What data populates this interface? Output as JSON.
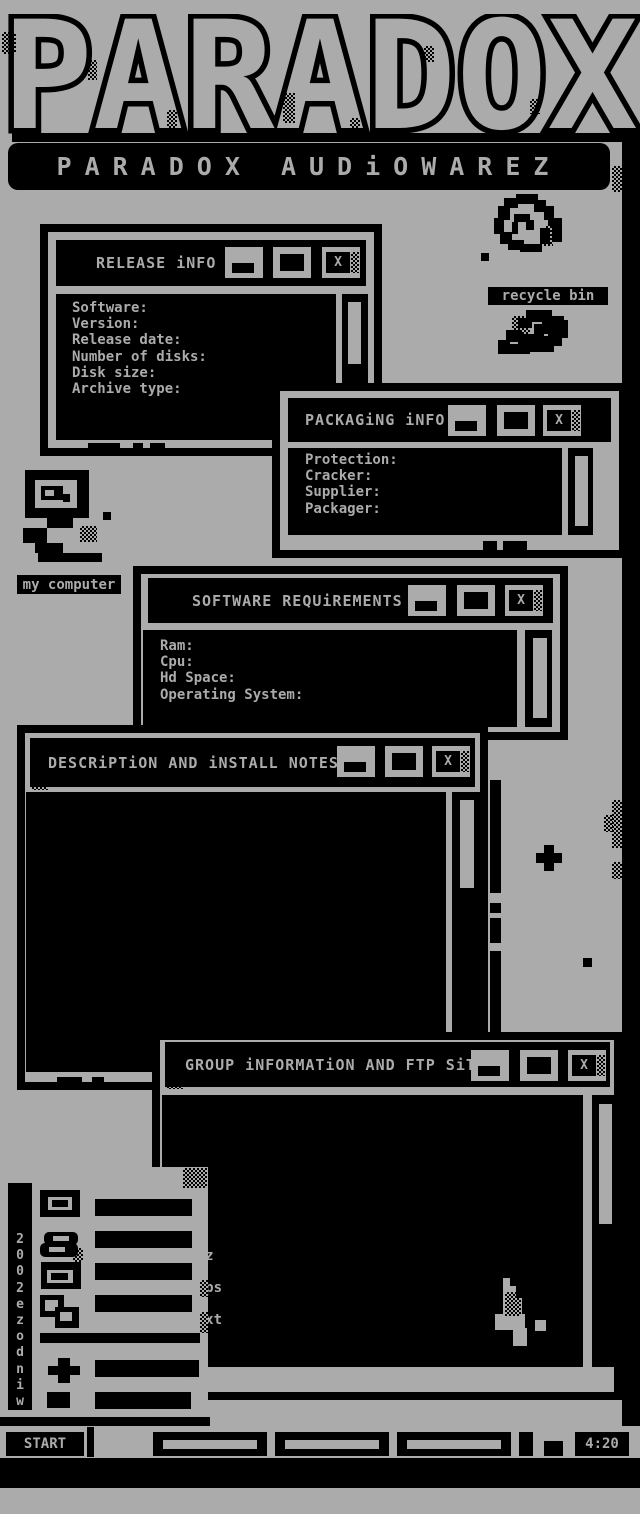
{
  "colors": {
    "bg": "#ababab",
    "fg": "#000000"
  },
  "logo": {
    "text": "PARADOX",
    "banner": "PARADOX AUDiOWAREZ"
  },
  "window_chrome": {
    "close_label": "X"
  },
  "windows": {
    "release": {
      "title": "RELEASE iNFO",
      "fields": [
        "Software:",
        "Version:",
        "Release date:",
        "Number of disks:",
        "Disk size:",
        "Archive type:"
      ]
    },
    "packaging": {
      "title": "PACKAGiNG iNFO",
      "fields": [
        "Protection:",
        "Cracker:",
        "Supplier:",
        "Packager:"
      ]
    },
    "software": {
      "title": "SOFTWARE REQUiREMENTS",
      "fields": [
        "Ram:",
        "Cpu:",
        "Hd Space:",
        "Operating System:"
      ]
    },
    "description": {
      "title": "DESCRiPTiON AND iNSTALL NOTES"
    },
    "group": {
      "title": "GROUP iNFORMATiON AND FTP SiTES"
    }
  },
  "desktop_icons": {
    "recycle_bin_label": "recycle bin",
    "my_computer_label": "my computer"
  },
  "start_menu": {
    "side_text": "2002ezodniw",
    "items": [
      {
        "label": "0wnz 2k2"
      },
      {
        "label": "get warez"
      },
      {
        "label": "elite apps"
      },
      {
        "label": "2_1337.txt"
      },
      {
        "label": "reboot cpu"
      },
      {
        "label": "shutdown"
      }
    ]
  },
  "taskbar": {
    "start_label": "START",
    "clock": "4:20"
  },
  "footer": {
    "credit": "nfo by j33p33!0wnZ"
  }
}
